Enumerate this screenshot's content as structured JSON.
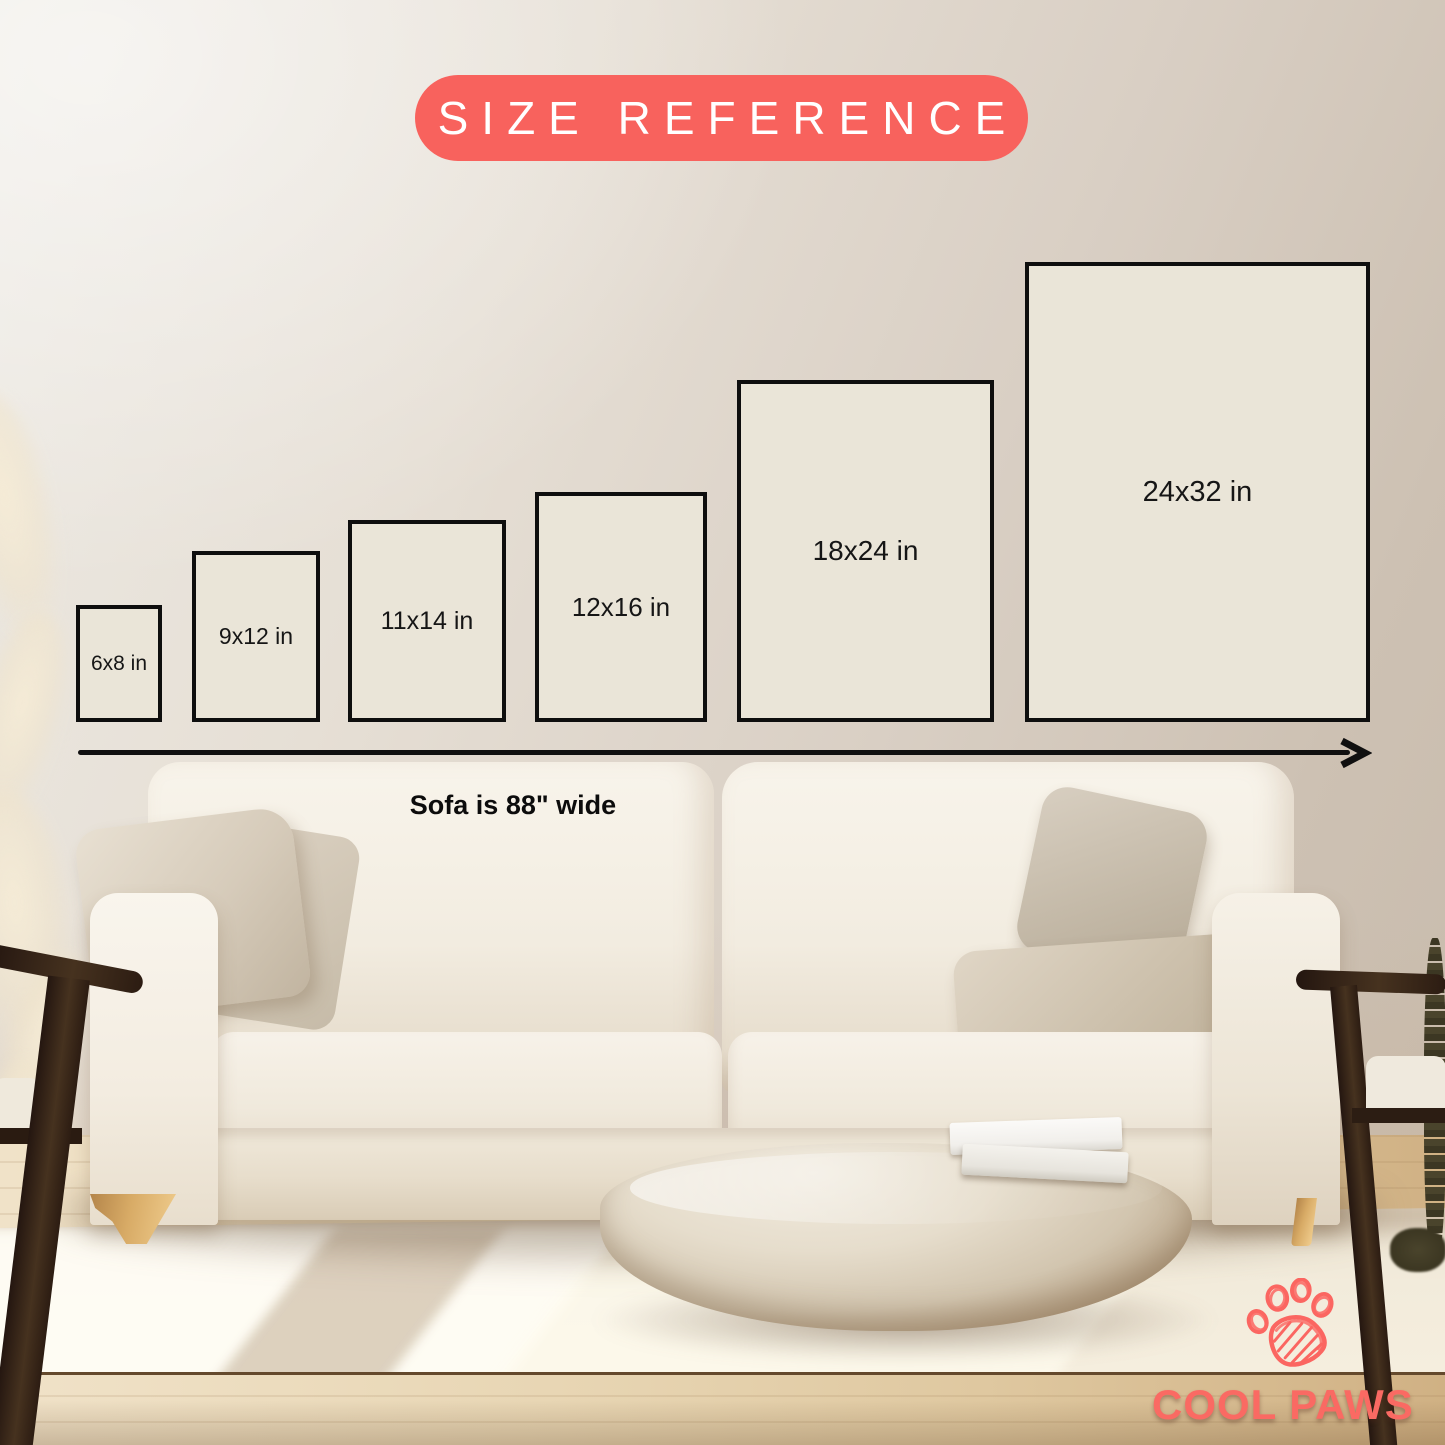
{
  "title": {
    "label": "SIZE REFERENCE"
  },
  "frames": [
    {
      "label": "6x8 in"
    },
    {
      "label": "9x12 in"
    },
    {
      "label": "11x14 in"
    },
    {
      "label": "12x16 in"
    },
    {
      "label": "18x24 in"
    },
    {
      "label": "24x32 in"
    }
  ],
  "axis": {
    "caption": "Sofa is 88\" wide"
  },
  "brand": {
    "name": "COOL PAWS",
    "icon": "paw-icon"
  },
  "colors": {
    "accent": "#f8625d",
    "frame_fill": "#eae5d8",
    "frame_border": "#0e0e0e",
    "label_text": "#161616",
    "brand_text": "#fa6a63"
  }
}
